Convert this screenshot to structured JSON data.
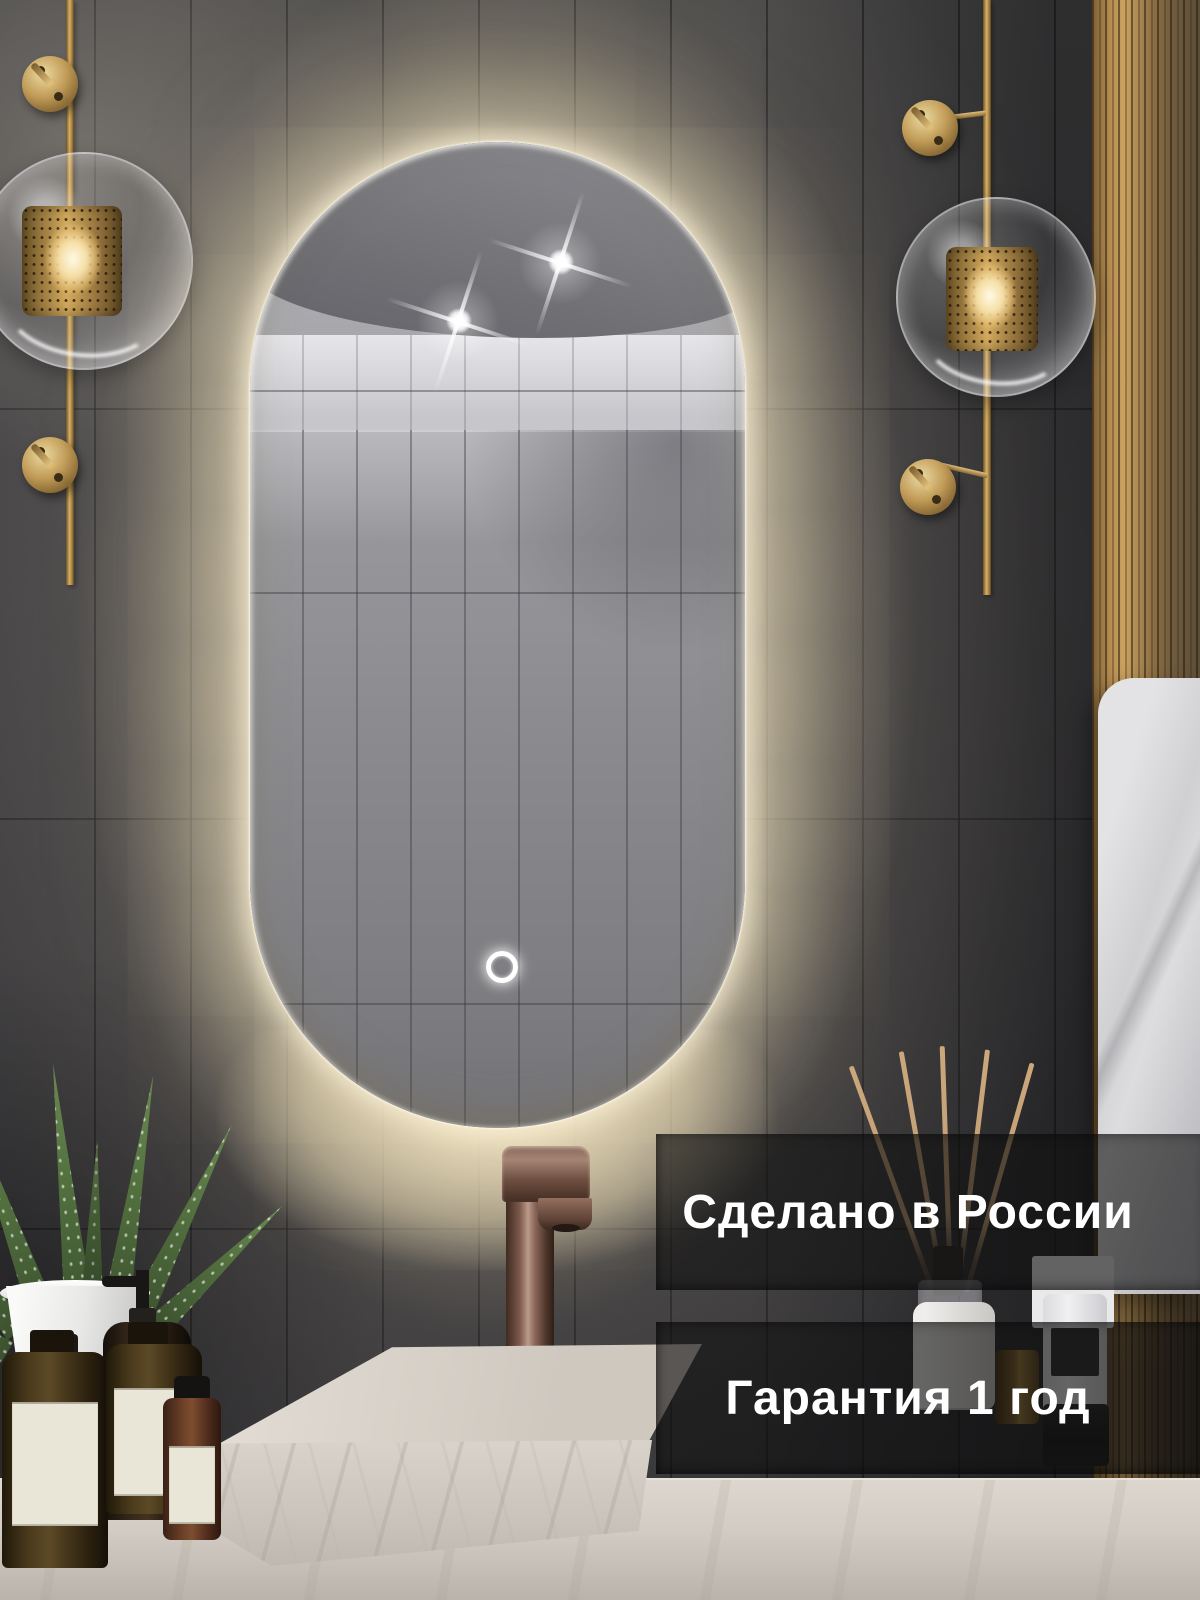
{
  "badges": {
    "made_in_russia": "Сделано в России",
    "warranty": "Гарантия 1 год"
  },
  "style": {
    "banner_bg": "rgba(16,16,16,0.62)",
    "banner_text": "#ffffff",
    "glow": "rgba(252,242,216,0.85)",
    "brass": "#d7b267",
    "wood": "#b98f52",
    "marble": "#ddd7cf",
    "bronze": "#7b584a",
    "towel": "#d6d6d8",
    "plant": "#53713f",
    "amber": "#4a3a1c",
    "wall": "#3f3e41"
  }
}
